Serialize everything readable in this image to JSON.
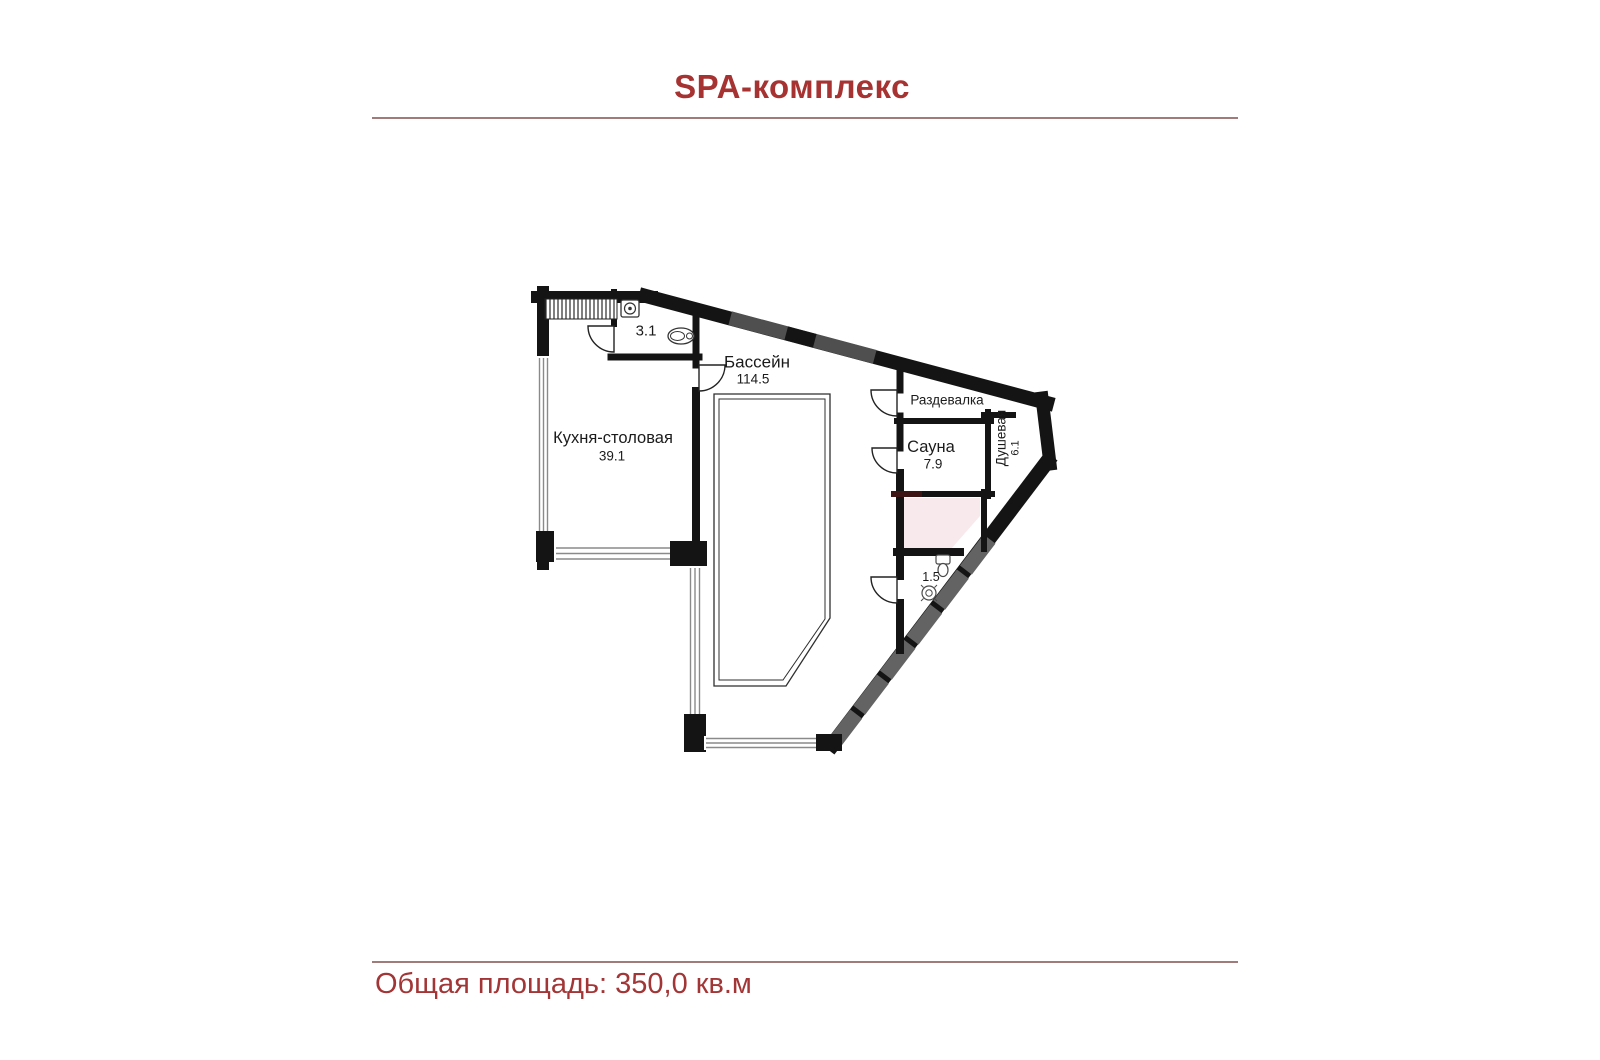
{
  "page": {
    "title": "SPA-комплекс",
    "footer": "Общая площадь: 350,0 кв.м",
    "accent_color": "#a63232",
    "divider_color": "#a17a7a",
    "wall_color": "#141414",
    "highlight_room_fill": "#f8e9ec"
  },
  "rooms": {
    "wc_top": {
      "area": "3.1"
    },
    "pool": {
      "name": "Бассейн",
      "area": "114.5"
    },
    "kitchen": {
      "name": "Кухня-столовая",
      "area": "39.1"
    },
    "dressing": {
      "name": "Раздевалка"
    },
    "sauna": {
      "name": "Сауна",
      "area": "7.9"
    },
    "shower": {
      "name": "Душевая",
      "area": "6.1"
    },
    "wc_bottom": {
      "area": "1.5"
    }
  }
}
